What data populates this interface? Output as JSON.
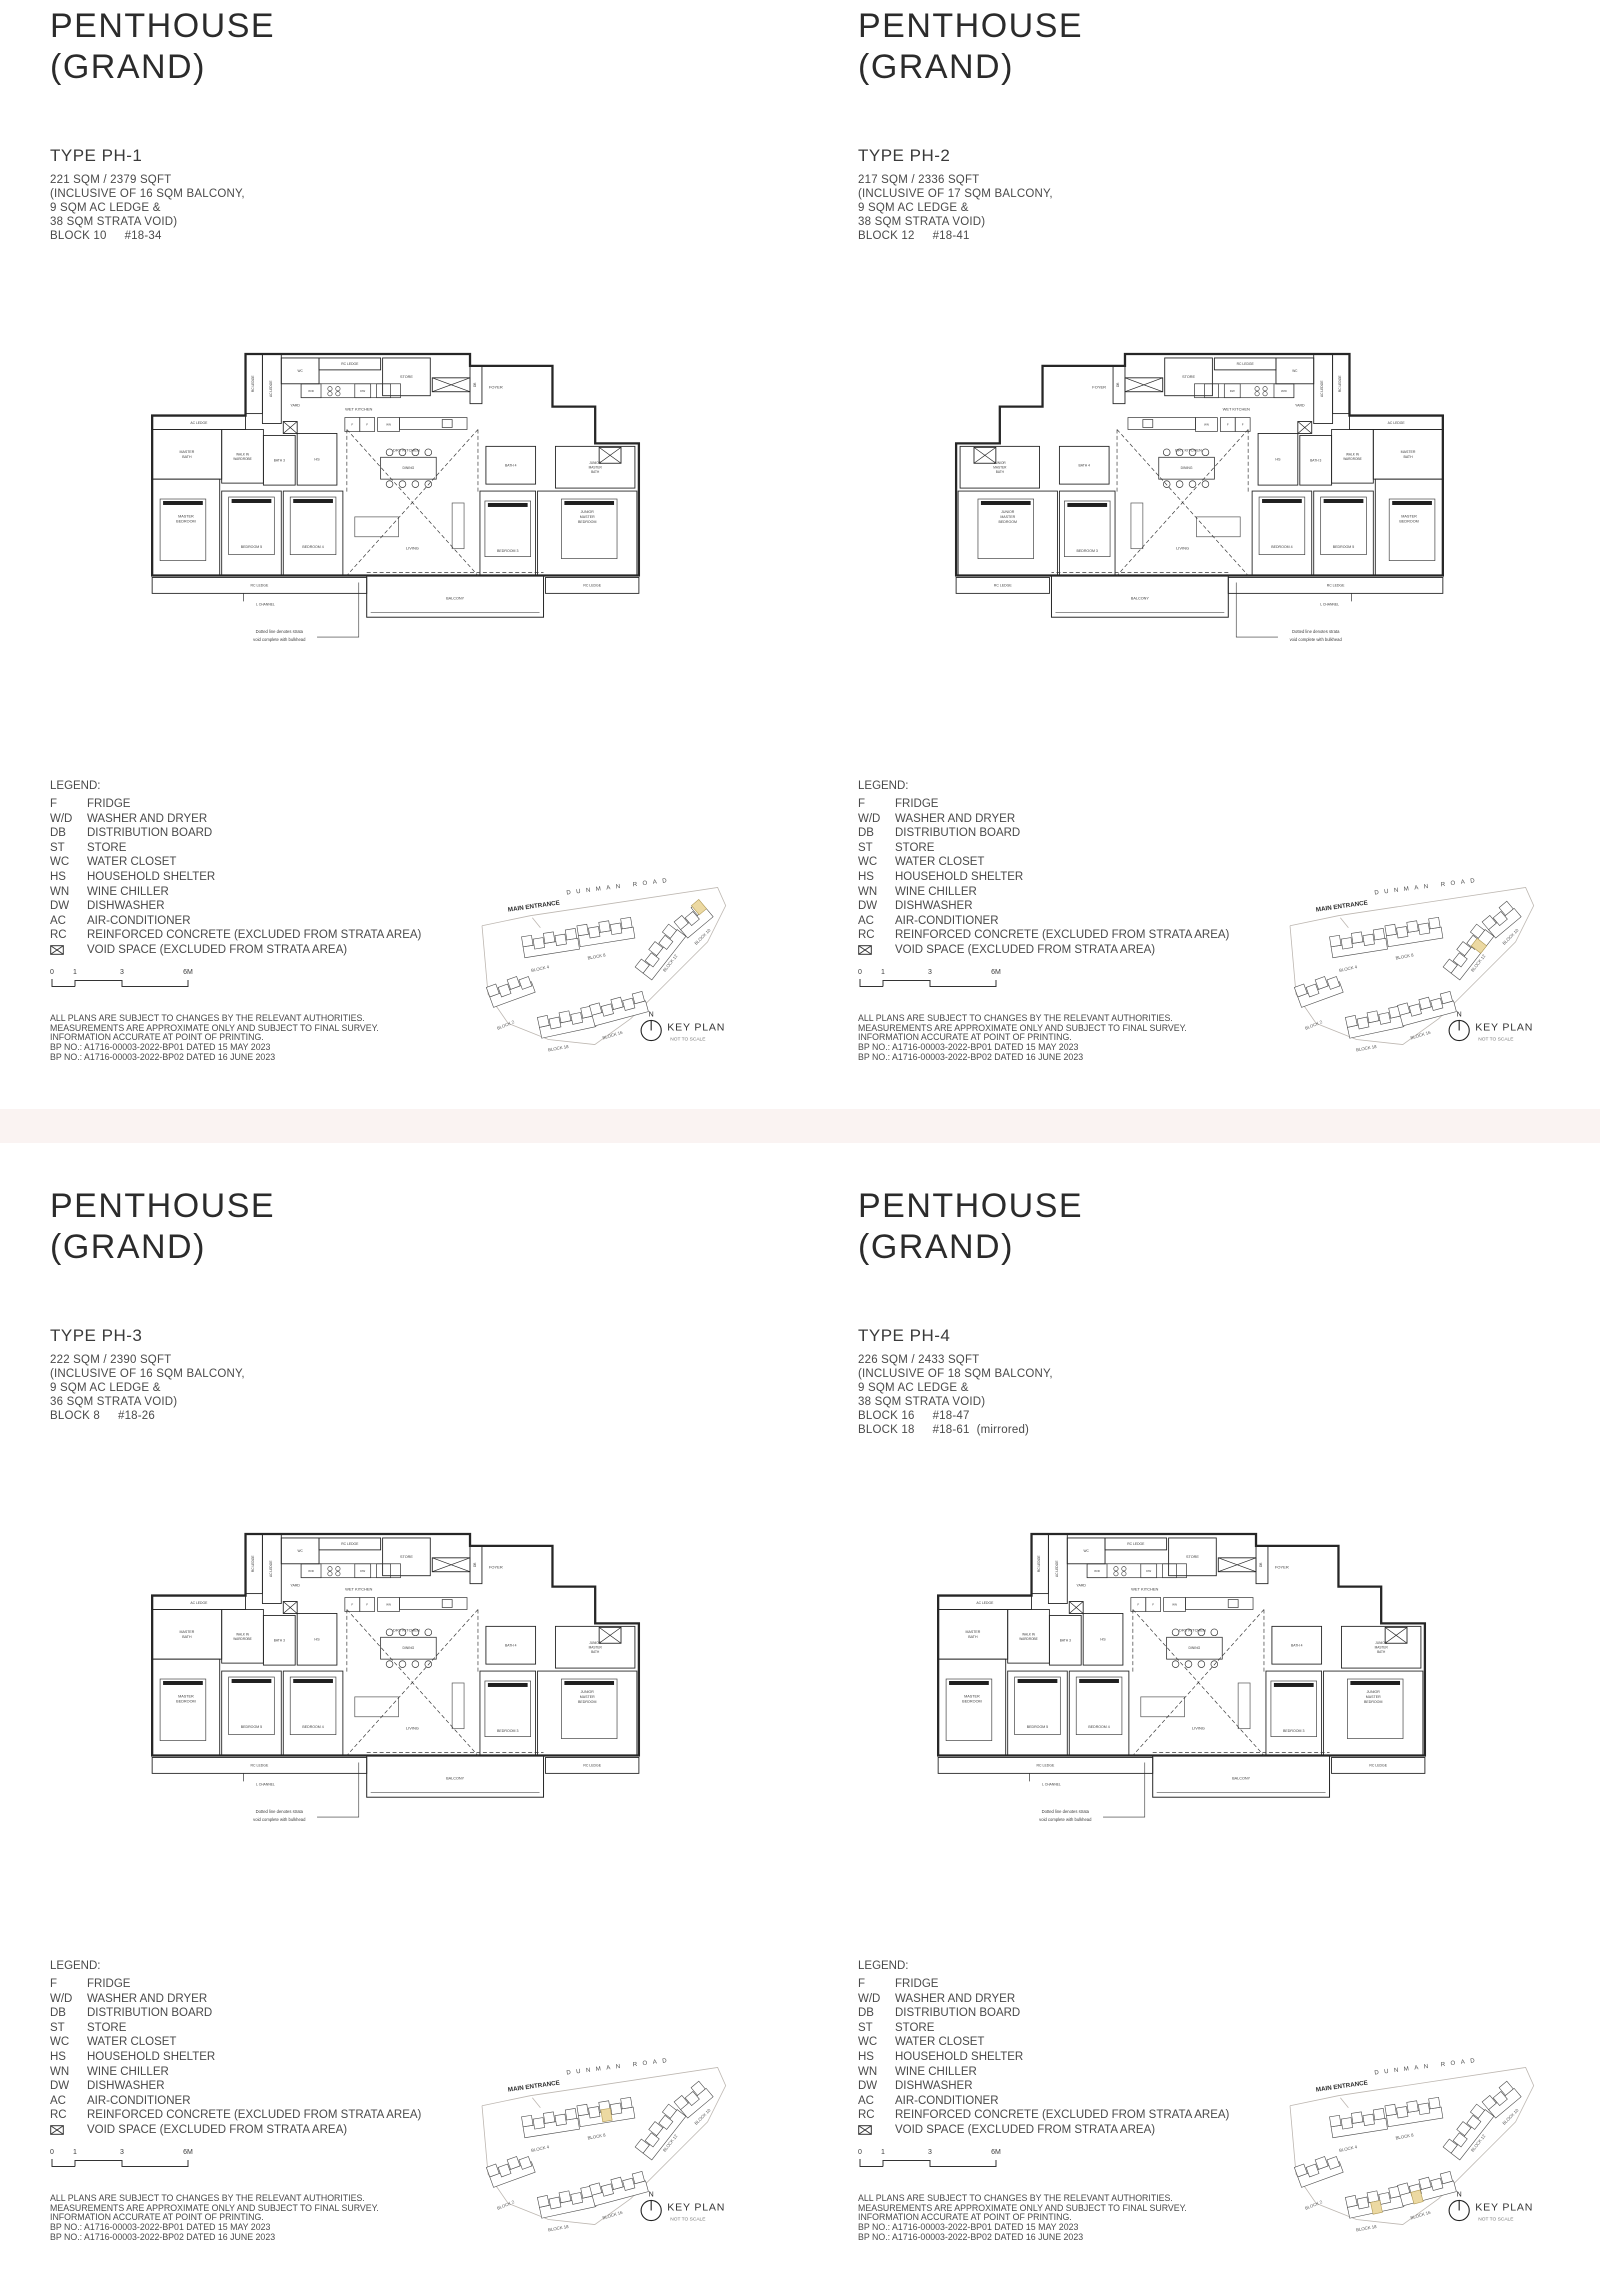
{
  "page": {
    "background": "#ffffff",
    "divider_color": "#FAF3F2",
    "line_color": "#222222",
    "text_color": "#4a4a4a",
    "highlight_color": "#ECD9A2"
  },
  "shared": {
    "title_line1": "PENTHOUSE",
    "title_line2": "(GRAND)",
    "legend": {
      "heading": "LEGEND:",
      "items": [
        {
          "abbr": "F",
          "desc": "FRIDGE"
        },
        {
          "abbr": "W/D",
          "desc": "WASHER AND DRYER"
        },
        {
          "abbr": "DB",
          "desc": "DISTRIBUTION BOARD"
        },
        {
          "abbr": "ST",
          "desc": "STORE"
        },
        {
          "abbr": "WC",
          "desc": "WATER CLOSET"
        },
        {
          "abbr": "HS",
          "desc": "HOUSEHOLD SHELTER"
        },
        {
          "abbr": "WN",
          "desc": "WINE CHILLER"
        },
        {
          "abbr": "DW",
          "desc": "DISHWASHER"
        },
        {
          "abbr": "AC",
          "desc": "AIR-CONDITIONER"
        },
        {
          "abbr": "RC",
          "desc": "REINFORCED CONCRETE (EXCLUDED FROM STRATA AREA)"
        },
        {
          "abbr": "",
          "icon": "void-space-icon",
          "desc": "VOID SPACE (EXCLUDED FROM STRATA AREA)"
        }
      ]
    },
    "scale": {
      "labels": [
        "0",
        "1",
        "3",
        "6M"
      ],
      "xs": [
        2,
        25,
        72,
        138
      ]
    },
    "disclaimer": [
      "ALL PLANS ARE SUBJECT TO CHANGES BY THE RELEVANT AUTHORITIES.",
      "MEASUREMENTS ARE APPROXIMATE ONLY AND SUBJECT TO FINAL SURVEY.",
      "INFORMATION ACCURATE AT POINT OF PRINTING.",
      "BP NO.: A1716-00003-2022-BP01 DATED 15 MAY 2023",
      "BP NO.: A1716-00003-2022-BP02 DATED 16 JUNE 2023"
    ],
    "keyplan": {
      "title": "KEY PLAN",
      "subtitle": "NOT TO SCALE",
      "north": "N",
      "main_entrance": "MAIN ENTRANCE",
      "road": "DUNMAN ROAD",
      "boundary": [
        [
          2,
          80
        ],
        [
          50,
          70
        ],
        [
          236,
          42
        ],
        [
          244,
          60
        ],
        [
          226,
          96
        ],
        [
          190,
          132
        ],
        [
          150,
          172
        ],
        [
          114,
          198
        ],
        [
          68,
          193
        ],
        [
          28,
          177
        ],
        [
          8,
          148
        ],
        [
          2,
          80
        ]
      ],
      "entrance_tick": [
        52,
        72,
        60,
        82
      ],
      "clusters": [
        {
          "x": 42,
          "y": 96,
          "r": -9,
          "n": 5,
          "label": "BLOCK 4",
          "lx": 60,
          "ly": 124,
          "lr": -12
        },
        {
          "x": 97,
          "y": 85,
          "r": -9,
          "n": 5,
          "label": "BLOCK 8",
          "lx": 116,
          "ly": 112,
          "lr": -10
        },
        {
          "x": 8,
          "y": 146,
          "r": -20,
          "n": 4,
          "label": "BLOCK 2",
          "lx": 26,
          "ly": 180,
          "lr": -22
        },
        {
          "x": 58,
          "y": 176,
          "r": -12,
          "n": 5,
          "label": "BLOCK 18",
          "lx": 78,
          "ly": 203,
          "lr": -10
        },
        {
          "x": 110,
          "y": 164,
          "r": -15,
          "n": 5,
          "label": "BLOCK 16",
          "lx": 132,
          "ly": 190,
          "lr": -17
        },
        {
          "x": 158,
          "y": 124,
          "r": -52,
          "n": 5,
          "label": "BLOCK 12",
          "lx": 190,
          "ly": 118,
          "lr": -52
        },
        {
          "x": 196,
          "y": 80,
          "r": -40,
          "n": 3,
          "label": "BLOCK 10",
          "lx": 222,
          "ly": 92,
          "lr": -45
        }
      ],
      "compass": {
        "cx": 170,
        "cy": 184,
        "r": 10
      }
    },
    "plan": {
      "outline": [
        [
          96,
          2
        ],
        [
          322,
          2
        ],
        [
          322,
          14
        ],
        [
          405,
          14
        ],
        [
          405,
          55
        ],
        [
          448,
          55
        ],
        [
          448,
          92
        ],
        [
          492,
          92
        ],
        [
          492,
          225
        ],
        [
          2,
          225
        ],
        [
          2,
          64
        ],
        [
          96,
          64
        ]
      ],
      "strips": [
        {
          "x": 96,
          "y": 2,
          "w": 17,
          "h": 60,
          "t": "RC LEDGE"
        },
        {
          "x": 113,
          "y": 2,
          "w": 19,
          "h": 70,
          "t": "AC LEDGE"
        },
        {
          "x": 322,
          "y": 14,
          "w": 12,
          "h": 38,
          "t": "DB"
        }
      ],
      "rooms": [
        {
          "x": 132,
          "y": 6,
          "w": 38,
          "h": 26,
          "t": "WC",
          "fs": 3.2
        },
        {
          "x": 170,
          "y": 6,
          "w": 62,
          "h": 12,
          "t": "RC LEDGE",
          "fs": 3.4
        },
        {
          "x": 234,
          "y": 6,
          "w": 48,
          "h": 38,
          "t": "STORE",
          "fs": 3.8
        },
        {
          "x": 2,
          "y": 64,
          "w": 94,
          "h": 14,
          "t": "AC LEDGE",
          "fs": 3.4
        },
        {
          "x": 2,
          "y": 78,
          "w": 70,
          "h": 50,
          "t": "MASTER\nBATH",
          "fs": 3.6
        },
        {
          "x": 72,
          "y": 78,
          "w": 42,
          "h": 54,
          "t": "WALK IN\nWARDROBE",
          "fs": 3.2
        },
        {
          "x": 114,
          "y": 84,
          "w": 32,
          "h": 50,
          "t": "BATH 3",
          "fs": 3.3
        },
        {
          "x": 148,
          "y": 82,
          "w": 40,
          "h": 52,
          "t": "HS",
          "fs": 3.8
        },
        {
          "x": 338,
          "y": 95,
          "w": 50,
          "h": 38,
          "t": "BATH 4",
          "fs": 3.4
        },
        {
          "x": 408,
          "y": 95,
          "w": 80,
          "h": 42,
          "t": "JUNIOR\nMASTER\nBATH",
          "fs": 3.2
        },
        {
          "x": 2,
          "y": 128,
          "w": 68,
          "h": 97,
          "t": "MASTER\nBEDROOM",
          "fs": 3.8,
          "ly": 168
        },
        {
          "x": 72,
          "y": 140,
          "w": 60,
          "h": 85,
          "t": "BEDROOM 5",
          "fs": 3.6,
          "ly": 196
        },
        {
          "x": 134,
          "y": 140,
          "w": 60,
          "h": 85,
          "t": "BEDROOM 4",
          "fs": 3.6,
          "ly": 196
        },
        {
          "x": 332,
          "y": 140,
          "w": 56,
          "h": 85,
          "t": "BEDROOM 3",
          "fs": 3.6,
          "ly": 200
        },
        {
          "x": 390,
          "y": 140,
          "w": 100,
          "h": 85,
          "t": "JUNIOR\nMASTER\nBEDROOM",
          "fs": 3.6,
          "ly": 166
        },
        {
          "x": 206,
          "y": 166,
          "w": 44,
          "h": 20
        },
        {
          "x": 304,
          "y": 152,
          "w": 12,
          "h": 46
        }
      ],
      "boxes": [
        {
          "x": 152,
          "y": 32,
          "w": 100,
          "h": 14
        },
        {
          "x": 152,
          "y": 32,
          "w": 20,
          "h": 14,
          "t": "W/D"
        },
        {
          "x": 206,
          "y": 32,
          "w": 16,
          "h": 14,
          "t": "DW"
        },
        {
          "x": 228,
          "y": 32,
          "w": 14,
          "h": 14
        },
        {
          "x": 196,
          "y": 66,
          "w": 15,
          "h": 14,
          "t": "F"
        },
        {
          "x": 211,
          "y": 66,
          "w": 15,
          "h": 14,
          "t": "F"
        },
        {
          "x": 229,
          "y": 66,
          "w": 22,
          "h": 14,
          "t": "WN"
        },
        {
          "x": 251,
          "y": 66,
          "w": 68,
          "h": 12
        },
        {
          "x": 294,
          "y": 68,
          "w": 10,
          "h": 8
        }
      ],
      "voids": [
        {
          "x": 284,
          "y": 26,
          "w": 38,
          "h": 14
        },
        {
          "x": 134,
          "y": 70,
          "w": 14,
          "h": 12
        },
        {
          "x": 452,
          "y": 96,
          "w": 22,
          "h": 16
        }
      ],
      "hob": [
        [
          181,
          37
        ],
        [
          189,
          37
        ],
        [
          181,
          42
        ],
        [
          189,
          42
        ]
      ],
      "labels": [
        {
          "x": 146,
          "y": 55,
          "t": "YARD",
          "fs": 3.6
        },
        {
          "x": 210,
          "y": 59,
          "t": "WET KITCHEN",
          "fs": 4
        },
        {
          "x": 258,
          "y": 100,
          "t": "DRY KITCHEN",
          "fs": 4
        },
        {
          "x": 348,
          "y": 37,
          "t": "FOYER",
          "fs": 4
        },
        {
          "x": 264,
          "y": 199,
          "t": "LIVING",
          "fs": 4
        }
      ],
      "ledges": [
        {
          "x": 2,
          "y": 227,
          "w": 216,
          "h": 16,
          "t": "RC LEDGE"
        },
        {
          "x": 398,
          "y": 227,
          "w": 94,
          "h": 16,
          "t": "RC LEDGE"
        }
      ],
      "balcony": {
        "x": 218,
        "y": 225,
        "w": 178,
        "h": 42,
        "t": "BALCONY"
      },
      "dashes": [
        [
          198,
          78,
          330,
          225
        ],
        [
          330,
          78,
          198,
          225
        ],
        [
          198,
          78,
          198,
          142
        ],
        [
          330,
          78,
          330,
          142
        ],
        [
          218,
          222,
          396,
          222
        ]
      ],
      "beds": [
        [
          10,
          148,
          46,
          62
        ],
        [
          79,
          146,
          46,
          58
        ],
        [
          141,
          146,
          46,
          58
        ],
        [
          337,
          150,
          46,
          56
        ],
        [
          414,
          148,
          56,
          60
        ]
      ],
      "dining": {
        "table": [
          232,
          106,
          56,
          22
        ],
        "chairs_x": [
          241,
          254,
          267,
          280
        ],
        "chairs_y": [
          101,
          133
        ],
        "r": 3.4,
        "label": "DINING",
        "lx": 260,
        "ly": 118
      },
      "note": {
        "line1": "Dotted line denotes strata",
        "line2": "void complete with bulkhead",
        "x": 130,
        "y1": 283,
        "y2": 291,
        "leader": [
          [
            168,
            287
          ],
          [
            210,
            287
          ],
          [
            210,
            232
          ]
        ]
      },
      "lchannel": {
        "line": [
          94,
          243,
          94,
          251
        ],
        "x": 116,
        "y": 255,
        "t": "L CHANNEL"
      }
    }
  },
  "units": [
    {
      "type": "TYPE PH-1",
      "area": "221 SQM / 2379 SQFT",
      "inclusive": [
        "(INCLUSIVE OF 16 SQM BALCONY,",
        "9 SQM AC LEDGE &",
        "38 SQM STRATA VOID)"
      ],
      "blocks": [
        {
          "block": "BLOCK 10",
          "unit": "#18-34",
          "note": ""
        }
      ],
      "mirrored": false,
      "highlights": [
        [
          210,
          60,
          -40
        ]
      ]
    },
    {
      "type": "TYPE PH-2",
      "area": "217 SQM / 2336 SQFT",
      "inclusive": [
        "(INCLUSIVE OF 17 SQM BALCONY,",
        "9 SQM AC LEDGE &",
        "38 SQM STRATA VOID)"
      ],
      "blocks": [
        {
          "block": "BLOCK 12",
          "unit": "#18-41",
          "note": ""
        }
      ],
      "mirrored": true,
      "highlights": [
        [
          182,
          100,
          -52
        ]
      ]
    },
    {
      "type": "TYPE PH-3",
      "area": "222 SQM / 2390 SQFT",
      "inclusive": [
        "(INCLUSIVE OF 16 SQM BALCONY,",
        "9 SQM AC LEDGE &",
        "36 SQM STRATA VOID)"
      ],
      "blocks": [
        {
          "block": "BLOCK 8",
          "unit": "#18-26",
          "note": ""
        }
      ],
      "mirrored": false,
      "highlights": [
        [
          120,
          84,
          -9
        ]
      ]
    },
    {
      "type": "TYPE PH-4",
      "area": "226 SQM / 2433 SQFT",
      "inclusive": [
        "(INCLUSIVE OF 18 SQM BALCONY,",
        "9 SQM AC LEDGE &",
        "38 SQM STRATA VOID)"
      ],
      "blocks": [
        {
          "block": "BLOCK 16",
          "unit": "#18-47",
          "note": ""
        },
        {
          "block": "BLOCK 18",
          "unit": "#18-61",
          "note": "(mirrored)"
        }
      ],
      "mirrored": false,
      "highlights": [
        [
          122,
          166,
          -15
        ],
        [
          82,
          176,
          -12
        ]
      ]
    }
  ]
}
